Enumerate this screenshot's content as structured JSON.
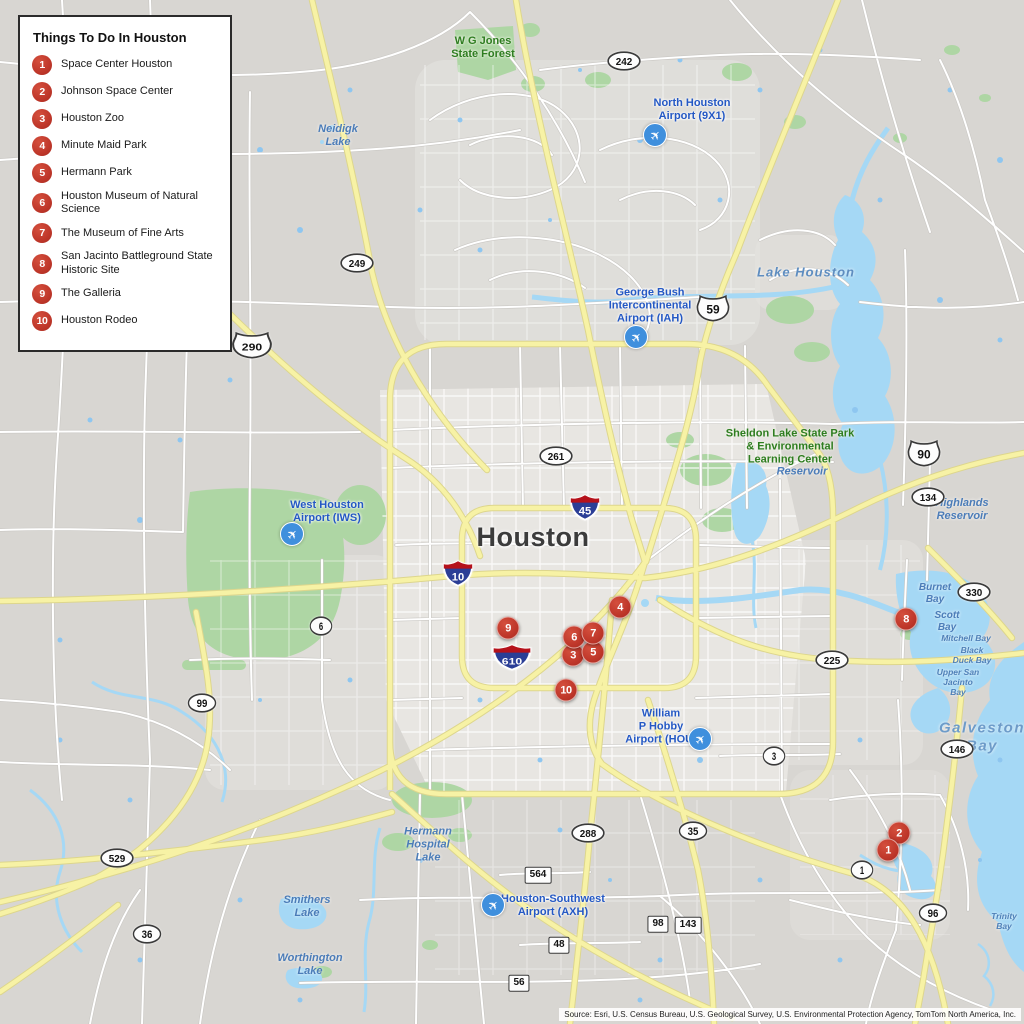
{
  "legend": {
    "title": "Things To Do In Houston",
    "items": [
      {
        "num": "1",
        "label": "Space Center Houston"
      },
      {
        "num": "2",
        "label": "Johnson Space Center"
      },
      {
        "num": "3",
        "label": "Houston Zoo"
      },
      {
        "num": "4",
        "label": "Minute Maid Park"
      },
      {
        "num": "5",
        "label": "Hermann Park"
      },
      {
        "num": "6",
        "label": "Houston Museum of Natural Science"
      },
      {
        "num": "7",
        "label": "The Museum of Fine Arts"
      },
      {
        "num": "8",
        "label": "San Jacinto Battleground State Historic Site"
      },
      {
        "num": "9",
        "label": "The Galleria"
      },
      {
        "num": "10",
        "label": "Houston Rodeo"
      }
    ]
  },
  "map": {
    "attribution": "Source: Esri, U.S. Census Bureau, U.S. Geological Survey, U.S. Environmental Protection Agency, TomTom North America, Inc.",
    "colors": {
      "marker_red": "#bf372a",
      "highway_yellow": "#f7f2a5",
      "water_blue": "#a5d8f5",
      "park_green": "#aed6a4",
      "land_gray": "#d8d6d2",
      "interstate_blue": "#2b3e96",
      "interstate_red": "#b5121b"
    },
    "labels": [
      {
        "name": "label-wg-jones-state-forest",
        "cls": "park",
        "x": 483,
        "y": 48,
        "text": "W G Jones\nState Forest"
      },
      {
        "name": "label-north-houston-airport",
        "cls": "airport",
        "x": 692,
        "y": 110,
        "text": "North Houston\nAirport (9X1)"
      },
      {
        "name": "label-neidigk-lake",
        "cls": "water",
        "x": 338,
        "y": 136,
        "text": "Neidigk\nLake"
      },
      {
        "name": "label-lake-houston",
        "cls": "water water-md",
        "x": 806,
        "y": 272,
        "text": "Lake Houston"
      },
      {
        "name": "label-george-bush-airport",
        "cls": "airport",
        "x": 650,
        "y": 306,
        "text": "George Bush\nIntercontinental\nAirport (IAH)"
      },
      {
        "name": "label-sheldon-lake-state-park",
        "cls": "park",
        "x": 790,
        "y": 447,
        "text": "Sheldon Lake State Park\n& Environmental\nLearning Center"
      },
      {
        "name": "label-reservoir",
        "cls": "water",
        "x": 802,
        "y": 472,
        "text": "Reservoir"
      },
      {
        "name": "label-highlands-reservoir",
        "cls": "water",
        "x": 962,
        "y": 510,
        "text": "Highlands\nReservoir"
      },
      {
        "name": "label-west-houston-airport",
        "cls": "airport",
        "x": 327,
        "y": 512,
        "text": "West Houston\nAirport (IWS)"
      },
      {
        "name": "label-houston-city",
        "cls": "city",
        "x": 533,
        "y": 538,
        "text": "Houston"
      },
      {
        "name": "label-burnet-bay",
        "cls": "water water-sm",
        "x": 935,
        "y": 594,
        "text": "Burnet\nBay"
      },
      {
        "name": "label-scott-bay",
        "cls": "water water-sm",
        "x": 947,
        "y": 622,
        "text": "Scott\nBay"
      },
      {
        "name": "label-mitchell-bay",
        "cls": "water water-xs",
        "x": 966,
        "y": 638,
        "text": "Mitchell Bay"
      },
      {
        "name": "label-black-duck-bay",
        "cls": "water water-xs",
        "x": 972,
        "y": 655,
        "text": "Black\nDuck Bay"
      },
      {
        "name": "label-upper-san-jacinto-bay",
        "cls": "water water-xs",
        "x": 958,
        "y": 682,
        "text": "Upper San\nJacinto\nBay"
      },
      {
        "name": "label-william-p-hobby-airport",
        "cls": "airport",
        "x": 661,
        "y": 727,
        "text": "William\nP Hobby\nAirport (HOU)"
      },
      {
        "name": "label-galveston-bay",
        "cls": "water water-lg",
        "x": 982,
        "y": 737,
        "text": "Galveston\nBay"
      },
      {
        "name": "label-hermann-hospital-lake",
        "cls": "water",
        "x": 428,
        "y": 845,
        "text": "Hermann\nHospital\nLake"
      },
      {
        "name": "label-smithers-lake",
        "cls": "water",
        "x": 307,
        "y": 907,
        "text": "Smithers\nLake"
      },
      {
        "name": "label-worthington-lake",
        "cls": "water",
        "x": 310,
        "y": 965,
        "text": "Worthington\nLake"
      },
      {
        "name": "label-houston-southwest-airport",
        "cls": "airport",
        "x": 553,
        "y": 906,
        "text": "Houston-Southwest\nAirport (AXH)"
      },
      {
        "name": "label-trinity-bay",
        "cls": "water water-xs",
        "x": 1004,
        "y": 921,
        "text": "Trinity\nBay"
      }
    ],
    "shields": [
      {
        "type": "oval",
        "label": "242",
        "x": 624,
        "y": 61
      },
      {
        "type": "oval",
        "label": "249",
        "x": 357,
        "y": 263
      },
      {
        "type": "us",
        "label": "290",
        "x": 252,
        "y": 345
      },
      {
        "type": "us",
        "label": "59",
        "x": 713,
        "y": 308
      },
      {
        "type": "oval",
        "label": "261",
        "x": 556,
        "y": 456
      },
      {
        "type": "interstate",
        "label": "45",
        "x": 585,
        "y": 507
      },
      {
        "type": "interstate",
        "label": "10",
        "x": 458,
        "y": 573
      },
      {
        "type": "interstate",
        "label": "610",
        "x": 512,
        "y": 657
      },
      {
        "type": "oval",
        "label": "6",
        "x": 321,
        "y": 626
      },
      {
        "type": "us",
        "label": "90",
        "x": 924,
        "y": 453
      },
      {
        "type": "oval",
        "label": "134",
        "x": 928,
        "y": 497
      },
      {
        "type": "oval",
        "label": "330",
        "x": 974,
        "y": 592
      },
      {
        "type": "oval",
        "label": "225",
        "x": 832,
        "y": 660
      },
      {
        "type": "oval",
        "label": "99",
        "x": 202,
        "y": 703
      },
      {
        "type": "oval",
        "label": "3",
        "x": 774,
        "y": 756
      },
      {
        "type": "oval",
        "label": "146",
        "x": 957,
        "y": 749
      },
      {
        "type": "oval",
        "label": "529",
        "x": 117,
        "y": 858
      },
      {
        "type": "oval",
        "label": "36",
        "x": 147,
        "y": 934
      },
      {
        "type": "oval",
        "label": "288",
        "x": 588,
        "y": 833
      },
      {
        "type": "oval",
        "label": "35",
        "x": 693,
        "y": 831
      },
      {
        "type": "rect",
        "label": "564",
        "x": 538,
        "y": 875
      },
      {
        "type": "rect",
        "label": "98",
        "x": 658,
        "y": 924
      },
      {
        "type": "rect",
        "label": "143",
        "x": 688,
        "y": 925
      },
      {
        "type": "rect",
        "label": "48",
        "x": 559,
        "y": 945
      },
      {
        "type": "rect",
        "label": "56",
        "x": 519,
        "y": 983
      },
      {
        "type": "oval",
        "label": "1",
        "x": 862,
        "y": 870
      },
      {
        "type": "oval",
        "label": "96",
        "x": 933,
        "y": 913
      }
    ],
    "markers": [
      {
        "num": "2",
        "x": 899,
        "y": 833
      },
      {
        "num": "1",
        "x": 888,
        "y": 850
      },
      {
        "num": "3",
        "x": 573,
        "y": 655
      },
      {
        "num": "4",
        "x": 620,
        "y": 607
      },
      {
        "num": "5",
        "x": 593,
        "y": 652
      },
      {
        "num": "6",
        "x": 574,
        "y": 637
      },
      {
        "num": "7",
        "x": 593,
        "y": 633
      },
      {
        "num": "8",
        "x": 906,
        "y": 619
      },
      {
        "num": "9",
        "x": 508,
        "y": 628
      },
      {
        "num": "10",
        "x": 566,
        "y": 690
      }
    ],
    "airplane_icons": [
      {
        "x": 655,
        "y": 135
      },
      {
        "x": 636,
        "y": 337
      },
      {
        "x": 292,
        "y": 534
      },
      {
        "x": 700,
        "y": 739
      },
      {
        "x": 493,
        "y": 905
      }
    ]
  }
}
